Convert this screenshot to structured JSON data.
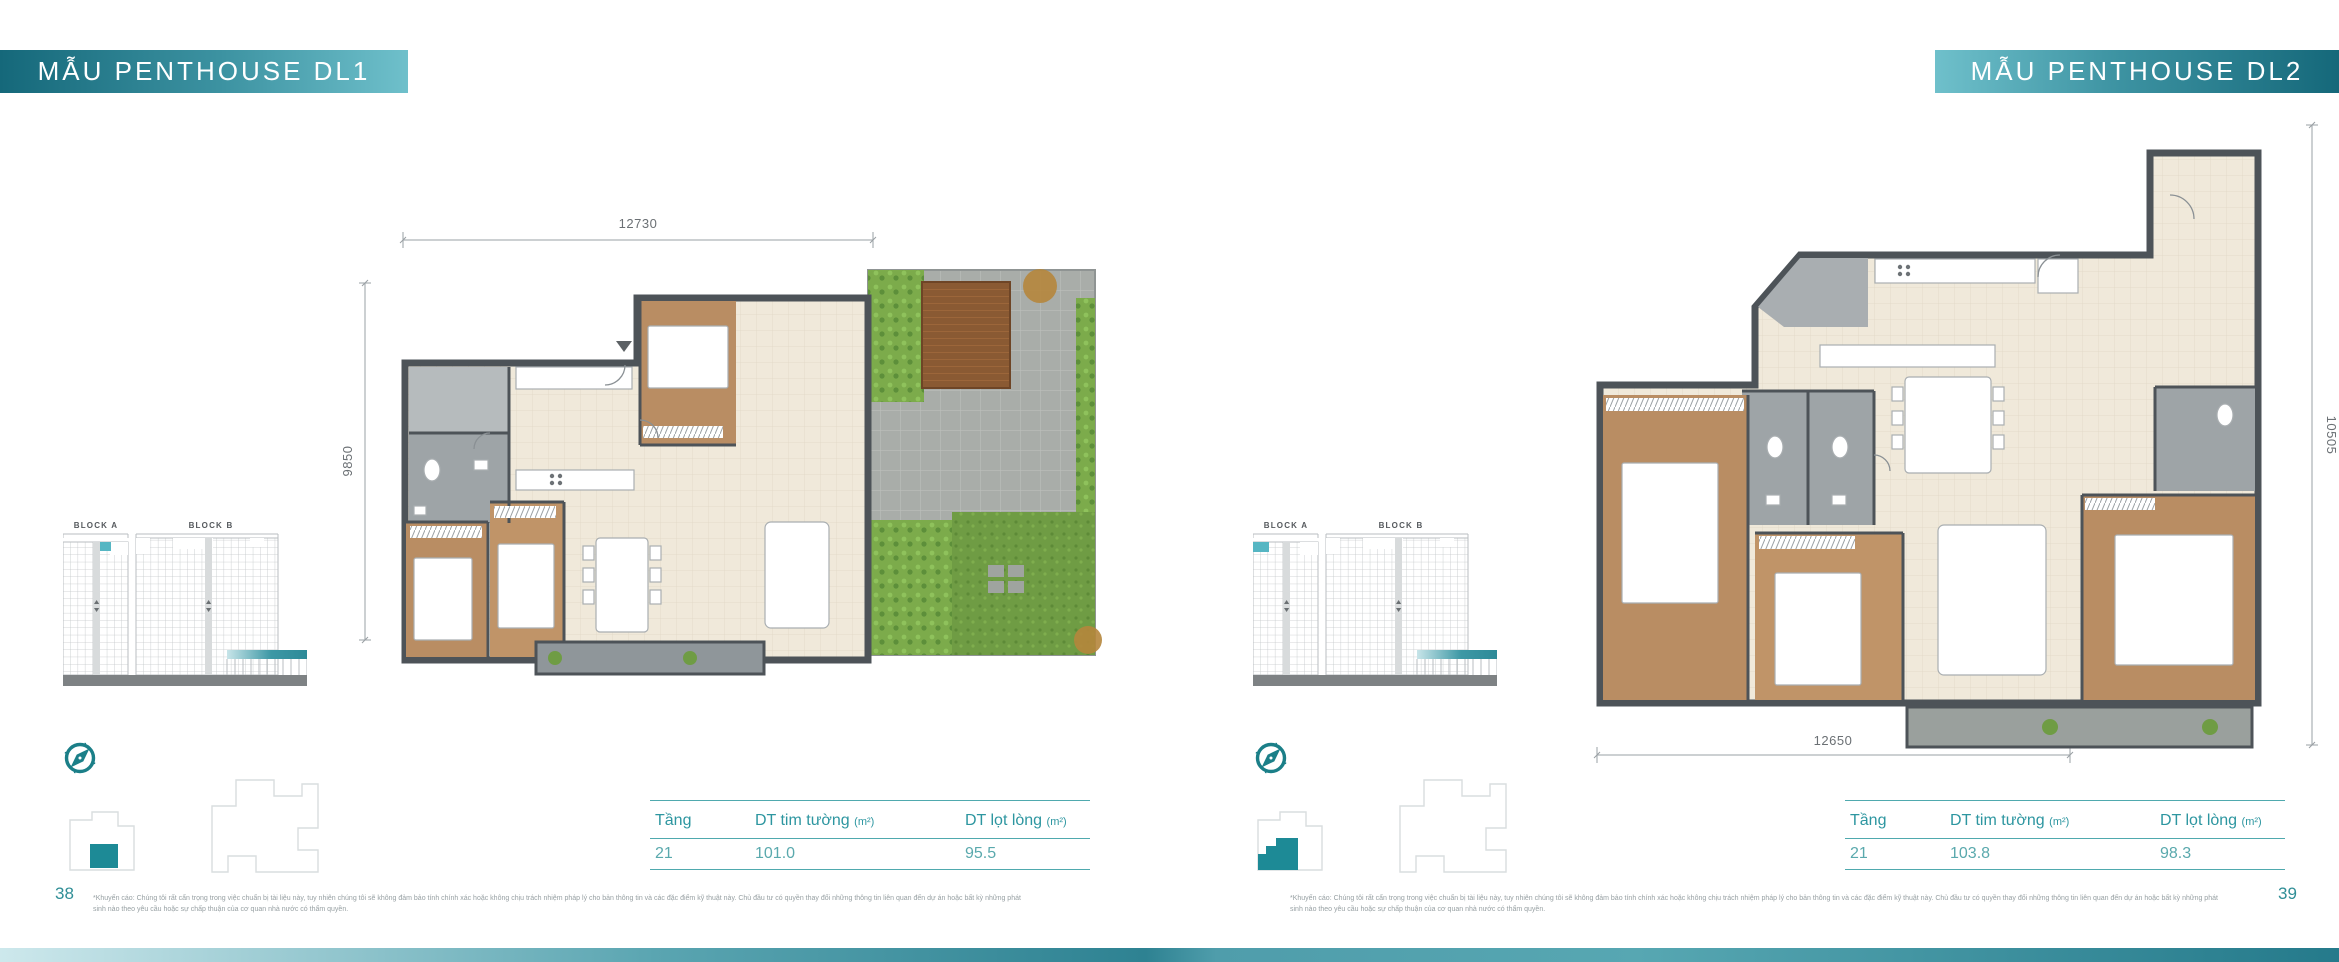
{
  "accent": {
    "teal": "#1d8a96",
    "badge_dark": "#15687a",
    "badge_light": "#6fc0cb",
    "table_line": "#4fa9ae"
  },
  "pages": [
    {
      "title": "MẪU PENTHOUSE DL1",
      "page_number": "38",
      "plan": {
        "dim_top": "12730",
        "dim_side": "9850"
      },
      "blocks": {
        "a": "BLOCK A",
        "b": "BLOCK B"
      },
      "table": {
        "col_floor": "Tầng",
        "col_gross": "DT tim tường",
        "col_gross_unit": "(m²)",
        "col_net": "DT lọt lòng",
        "col_net_unit": "(m²)",
        "floor": "21",
        "gross": "101.0",
        "net": "95.5"
      },
      "disclaimer_line1": "*Khuyến cáo: Chúng tôi rất cẩn trọng trong việc chuẩn bị tài liệu này, tuy nhiên chúng tôi sẽ không đảm bảo tính chính xác hoặc không chịu trách nhiệm pháp lý cho bản thông tin và các đặc điểm kỹ thuật này. Chủ đầu tư có quyền thay đổi những thông tin liên quan đến dự án hoặc bất kỳ những phát",
      "disclaimer_line2": "sinh nào theo yêu cầu hoặc sự chấp thuận của cơ quan nhà nước có thẩm quyền."
    },
    {
      "title": "MẪU PENTHOUSE DL2",
      "page_number": "39",
      "plan": {
        "dim_bottom": "12650",
        "dim_side": "10505"
      },
      "blocks": {
        "a": "BLOCK A",
        "b": "BLOCK B"
      },
      "table": {
        "col_floor": "Tầng",
        "col_gross": "DT tim tường",
        "col_gross_unit": "(m²)",
        "col_net": "DT lọt lòng",
        "col_net_unit": "(m²)",
        "floor": "21",
        "gross": "103.8",
        "net": "98.3"
      },
      "disclaimer_line1": "*Khuyến cáo: Chúng tôi rất cẩn trọng trong việc chuẩn bị tài liệu này, tuy nhiên chúng tôi sẽ không đảm bảo tính chính xác hoặc không chịu trách nhiệm pháp lý cho bản thông tin và các đặc điểm kỹ thuật này. Chủ đầu tư có quyền thay đổi những thông tin liên quan đến dự án hoặc bất kỳ những phát",
      "disclaimer_line2": "sinh nào theo yêu cầu hoặc sự chấp thuận của cơ quan nhà nước có thẩm quyền."
    }
  ]
}
